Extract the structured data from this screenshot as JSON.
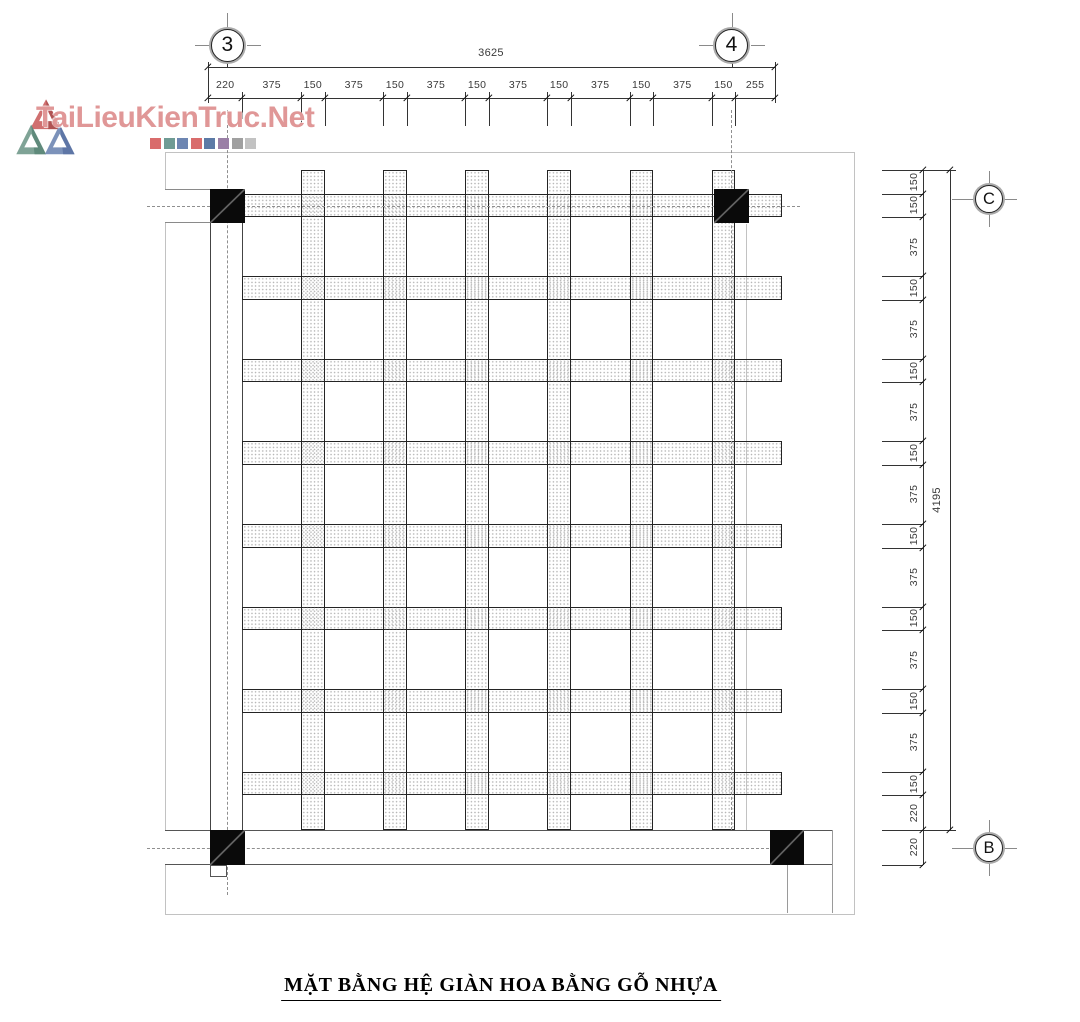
{
  "logo": {
    "text": "TaiLieuKienTruc.Net",
    "squares": [
      "#d96c6c",
      "#6f9b94",
      "#6d86b2",
      "#d96c6c",
      "#5c7aa6",
      "#9a7fa6",
      "#a0a0a0",
      "#c2c2c2"
    ]
  },
  "bubbles": {
    "b3": "3",
    "b4": "4",
    "bC": "C",
    "bB": "B"
  },
  "dimensions": {
    "top": {
      "total": "3625",
      "segments": [
        220,
        375,
        150,
        375,
        150,
        375,
        150,
        375,
        150,
        375,
        150,
        375,
        150,
        255
      ]
    },
    "right": {
      "total": "4195",
      "segments": [
        150,
        150,
        375,
        150,
        375,
        150,
        375,
        150,
        375,
        150,
        375,
        150,
        375,
        150,
        375,
        150,
        220
      ],
      "below_segments": [
        220
      ]
    }
  },
  "title": "MẶT BẰNG HỆ GIÀN HOA BẰNG GỖ NHỰA",
  "colors": {
    "beam_border": "#242424",
    "column": "#0a0a0a",
    "frame": "#c2c2c2",
    "dash": "#8f8f8f",
    "dim_text": "#3a3a3a",
    "logo_text": "#dd8c8c"
  }
}
